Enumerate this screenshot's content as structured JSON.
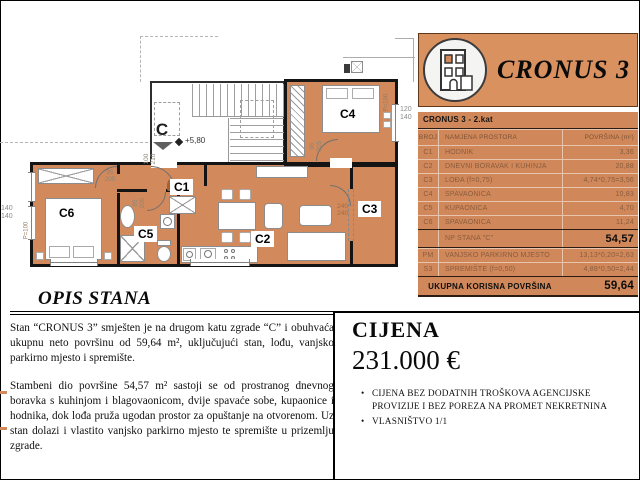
{
  "colors": {
    "accent": "#d28a5c",
    "banner": "#d9915f",
    "table": "#d0885a",
    "wall": "#141414"
  },
  "brand": {
    "name": "CRONUS 3"
  },
  "table": {
    "title": "CRONUS 3 - 2.kat",
    "columns": {
      "broj": "BROJ",
      "namjena": "NAMJENA PROSTORA",
      "povrsina": "POVRŠINA (m²)"
    },
    "rows": [
      {
        "broj": "C1",
        "namjena": "HODNIK",
        "povrsina": "3,36"
      },
      {
        "broj": "C2",
        "namjena": "DNEVNI BORAVAK I KUHINJA",
        "povrsina": "20,88"
      },
      {
        "broj": "C3",
        "namjena": "LOĐA (f=0,75)",
        "povrsina": "4,74*0,75=3,56"
      },
      {
        "broj": "C4",
        "namjena": "SPAVAONICA",
        "povrsina": "10,83"
      },
      {
        "broj": "C5",
        "namjena": "KUPAONICA",
        "povrsina": "4,70"
      },
      {
        "broj": "C6",
        "namjena": "SPAVAONICA",
        "povrsina": "11,24"
      }
    ],
    "subtotal": {
      "label": "NP STANA \"C\"",
      "value": "54,57"
    },
    "addons": [
      {
        "broj": "PM",
        "namjena": "VANJSKO PARKIRNO MJESTO",
        "povrsina": "13,13*0,20=2,63"
      },
      {
        "broj": "S3",
        "namjena": "SPREMIŠTE (f=0,50)",
        "povrsina": "4,88*0,50=2,44"
      }
    ],
    "total": {
      "label": "UKUPNA KORISNA POVRŠINA",
      "value": "59,64"
    }
  },
  "plan": {
    "core_label": "C",
    "elevation": "+5,80",
    "room_labels": [
      "C1",
      "C2",
      "C3",
      "C4",
      "C5",
      "C6"
    ],
    "dims": {
      "entrance_door": [
        "100",
        "210"
      ],
      "c6_door": [
        "95",
        "205"
      ],
      "c5_door": [
        "85",
        "205"
      ],
      "c4_door": [
        "95",
        "205"
      ],
      "loggia_door": [
        "240",
        "240"
      ],
      "window_left": [
        "140",
        "140"
      ],
      "window_right": [
        "120",
        "140"
      ],
      "parapet_left": "P=100",
      "parapet_right": "P=100"
    }
  },
  "opis": {
    "title": "OPIS STANA",
    "paragraphs": [
      "Stan “CRONUS 3” smješten je na drugom katu zgrade “C” i obuhvaća ukupnu neto površinu od 59,64 m², uključujući stan, lođu, vanjsko parkirno mjesto i spremište.",
      "Stambeni dio površine 54,57 m² sastoji se od prostranog dnevnog boravka s kuhinjom i blagovaonicom, dvije spavaće sobe, kupaonice i hodnika, dok lođa pruža ugodan prostor za opuštanje na otvorenom. Uz stan dolazi i vlastito vanjsko parkirno mjesto te spremište u prizemlju zgrade."
    ]
  },
  "price": {
    "title": "CIJENA",
    "amount": "231.000 €",
    "bullets": [
      "CIJENA BEZ DODATNIH TROŠKOVA AGENCIJSKE PROVIZIJE I BEZ POREZA NA PROMET NEKRETNINA",
      "VLASNIŠTVO 1/1"
    ]
  }
}
